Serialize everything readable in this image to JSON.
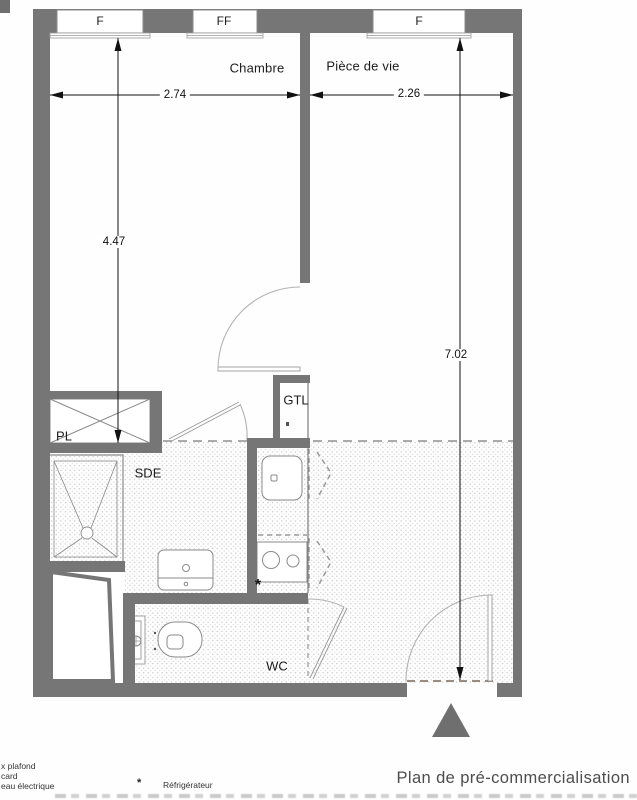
{
  "plan": {
    "title": "Plan de pré-commercialisation",
    "windows": [
      {
        "label": "F"
      },
      {
        "label": "FF"
      },
      {
        "label": "F"
      }
    ],
    "rooms": {
      "chambre": "Chambre",
      "piece_de_vie": "Pièce de vie",
      "sde": "SDE",
      "wc": "WC",
      "pl": "PL",
      "gtl": "GTL"
    },
    "dimensions": {
      "chambre_width": "2.74",
      "piece_de_vie_width": "2.26",
      "chambre_length": "4.47",
      "piece_de_vie_length": "7.02"
    },
    "kitchen_marker": "*",
    "legend": {
      "line1": "x plafond",
      "line2": "card",
      "line3": "eau électrique",
      "refrigerator_symbol": "*",
      "refrigerator_label": "Réfrigérateur"
    }
  },
  "colors": {
    "wall": "#767676",
    "fixture_line": "#8a8a8a",
    "door_arc": "#b3b3b3",
    "dashed_line": "#8f8f8f",
    "dimension": "#111111",
    "stipple_dot": "#bdbdbd",
    "entrance_triangle": "#6f6f6f",
    "threshold_dash": "#9a8c7e"
  }
}
